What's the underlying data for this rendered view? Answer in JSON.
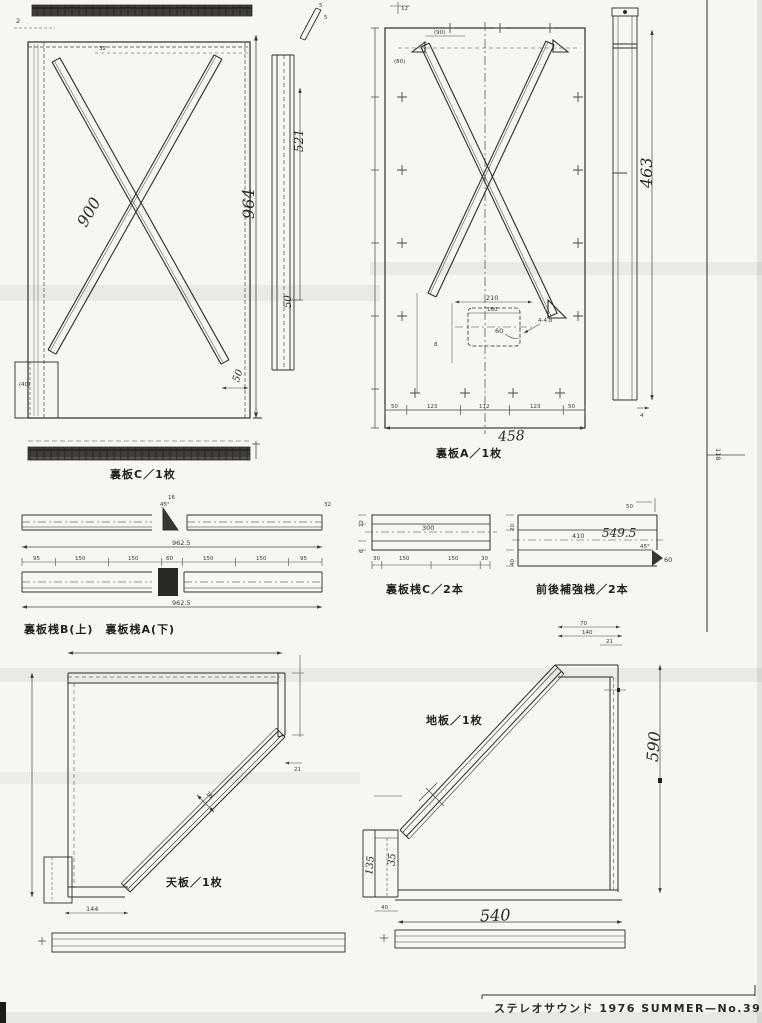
{
  "page": {
    "footer": "ステレオサウンド 1976 SUMMER—No.39",
    "edge_dim": "118"
  },
  "panel_c": {
    "label": "裏板C／1枚",
    "brace_dim": "900",
    "height_dim": "964",
    "side_dim": "521",
    "side_small": "50",
    "bottom_small": "50",
    "foot_dim": "(40)",
    "corner_dim": "2",
    "top_inner_dim": "32",
    "edge_small_a": "5",
    "edge_small_b": "5"
  },
  "panel_a": {
    "label": "裏板A／1枚",
    "width_dim": "458",
    "side_height": "463",
    "top_dim": "12",
    "corner_dim": "(90)",
    "left_dim": "(80)",
    "cutout_w": "210",
    "cutout_w2": "160",
    "cutout_h": "60",
    "holes": "4-4.8",
    "left_small": "8",
    "side_thick": "4",
    "seg_dims": [
      "50",
      "123",
      "112",
      "123",
      "50"
    ]
  },
  "rails_ba": {
    "label": "裏板桟B(上)　裏板桟A(下)",
    "upper_total": "962.5",
    "lower_total": "962.5",
    "wedge_angle": "45°",
    "wedge_dim": "16",
    "end_dim": "32",
    "seg_dims": [
      "95",
      "150",
      "150",
      "60",
      "150",
      "150",
      "95"
    ]
  },
  "rail_c": {
    "label": "裏板桟C／2本",
    "center_dim": "300",
    "left_top": "12",
    "left_bottom": "6",
    "seg_dims": [
      "30",
      "150",
      "150",
      "30"
    ]
  },
  "rail_fr": {
    "label": "前後補強桟／2本",
    "length_dim": "549.5",
    "center_dim": "410",
    "top_dim": "50",
    "angle": "45°",
    "bevel_dim": "60",
    "left_top": "20",
    "left_bottom": "40"
  },
  "top_board": {
    "label": "天板／1枚",
    "band_dim": "16",
    "right_dim": "21",
    "bottom_dim": "144"
  },
  "bottom_board": {
    "label": "地板／1枚",
    "height_dim": "590",
    "width_dim": "540",
    "top_dim1": "70",
    "top_dim2": "140",
    "right_small": "21",
    "foot_dim1": "135",
    "foot_dim2": "35",
    "foot_width": "40"
  }
}
